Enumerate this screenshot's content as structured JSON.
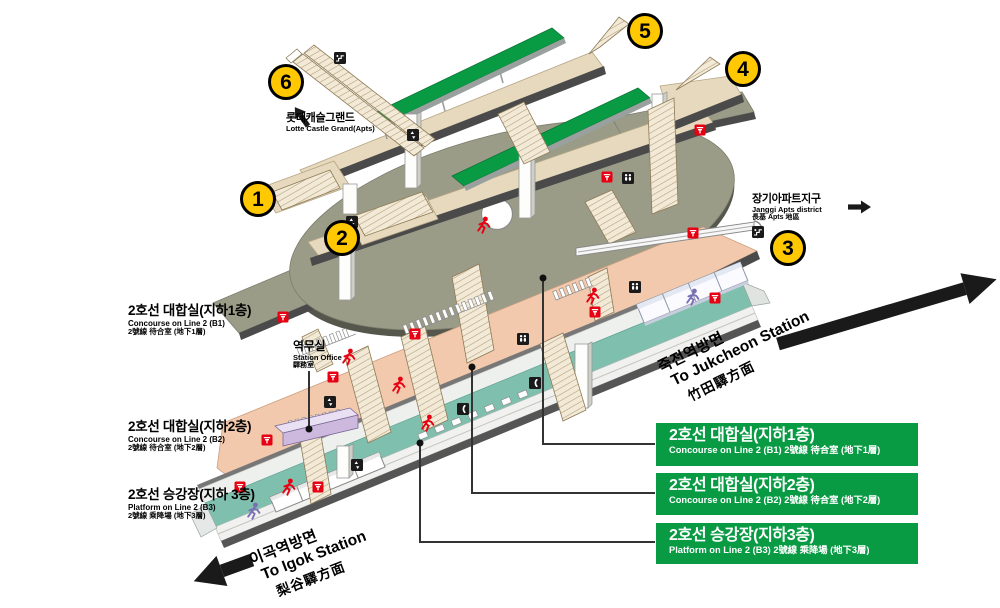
{
  "title": "Station 3D floor guide map",
  "line": {
    "name_ko": "2호선",
    "color": "#099b44"
  },
  "colors": {
    "exit_circle_yellow": "#ffc800",
    "line_green": "#099b44",
    "pictogram_red": "#e60012",
    "concourse_b1_olive": "#9b9c88",
    "concourse_b2_pink": "#f2c9ad",
    "platform_b3_teal": "#7fbfae",
    "walkway_tan": "#e7d9bd"
  },
  "exits": [
    {
      "number": "1"
    },
    {
      "number": "2"
    },
    {
      "number": "3"
    },
    {
      "number": "4"
    },
    {
      "number": "5"
    },
    {
      "number": "6"
    }
  ],
  "landmarks": {
    "lotte": {
      "ko": "롯데캐슬그랜드",
      "en": "Lotte Castle Grand(Apts)"
    },
    "janggi": {
      "ko": "장기아파트지구",
      "en": "Janggi Apts district",
      "hanja": "長基 Apts 地區"
    }
  },
  "facilities": {
    "station_office": {
      "ko": "역무실",
      "en": "Station Office",
      "hanja": "驛務室"
    }
  },
  "levels": {
    "b1": {
      "ko": "2호선 대합실(지하1층)",
      "en": "Concourse on Line 2 (B1)",
      "hanja": "2號線 待合室 (地下1層)"
    },
    "b2": {
      "ko": "2호선 대합실(지하2층)",
      "en": "Concourse on Line 2 (B2)",
      "hanja": "2號線 待合室 (地下2層)"
    },
    "b3": {
      "ko": "2호선 승강장(지하 3층)",
      "en": "Platform on Line 2 (B3)",
      "hanja": "2號線 乘降場 (地下3層)"
    }
  },
  "directions": {
    "igok": {
      "ko": "이곡역방면",
      "en": "To Igok Station",
      "hanja": "梨谷驛方面"
    },
    "jukcheon": {
      "ko": "죽전역방면",
      "en": "To Jukcheon Station",
      "hanja": "竹田驛方面"
    }
  },
  "legend_boxes": [
    {
      "title": "2호선 대합실(지하1층)",
      "subtitle": "Concourse on Line 2 (B1) 2號線 待合室 (地下1層)"
    },
    {
      "title": "2호선 대합실(지하2층)",
      "subtitle": "Concourse on Line 2 (B2) 2號線 待合室 (地下2層)"
    },
    {
      "title": "2호선 승강장(지하3층)",
      "subtitle": "Platform on Line 2 (B3) 2號線 乘降場 (地下3層)"
    }
  ],
  "icon_legend": [
    "fare-gate-icon",
    "restroom-icon",
    "elevator-icon",
    "escalator-icon",
    "phone-icon",
    "running-person-icon",
    "walking-person-icon"
  ]
}
